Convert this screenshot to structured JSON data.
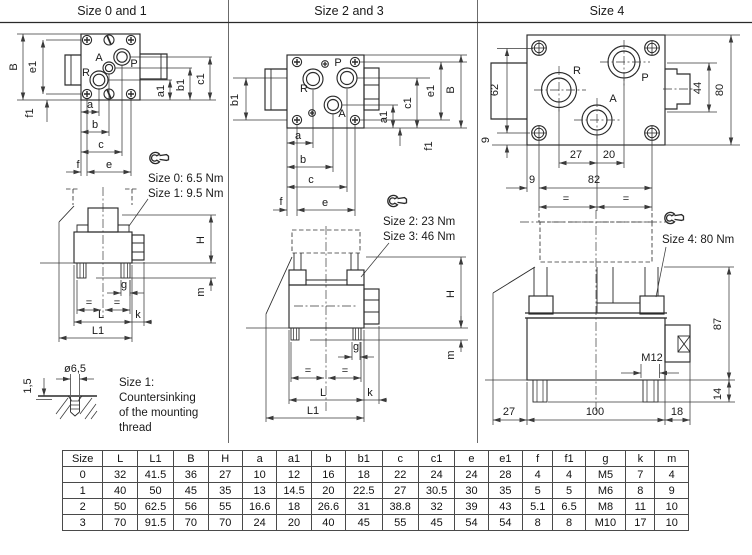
{
  "panels": {
    "p1": {
      "title": "Size 0 and 1"
    },
    "p2": {
      "title": "Size 2 and 3"
    },
    "p3": {
      "title": "Size 4"
    }
  },
  "d1": {
    "ports": {
      "r": "R",
      "a": "A",
      "p": "P"
    },
    "dims": {
      "B": "B",
      "e1": "e1",
      "f1": "f1",
      "a": "a",
      "b": "b",
      "c": "c",
      "e": "e",
      "f": "f",
      "a1": "a1",
      "b1": "b1",
      "c1": "c1",
      "H": "H",
      "m": "m",
      "g": "g",
      "k": "k",
      "L": "L",
      "L1": "L1",
      "eq": "="
    },
    "torque": {
      "line1": "Size 0: 6.5 Nm",
      "line2": "Size 1: 9.5 Nm"
    },
    "countersink": {
      "depth": "1,5",
      "diameter": "ø6,5",
      "note_line1": "Size 1:",
      "note_line2": "Countersinking",
      "note_line3": "of the mounting",
      "note_line4": "thread"
    }
  },
  "d2": {
    "ports": {
      "r": "R",
      "a": "A",
      "p": "P"
    },
    "dims": {
      "B": "B",
      "e1": "e1",
      "f1": "f1",
      "a": "a",
      "b": "b",
      "c": "c",
      "e": "e",
      "f": "f",
      "a1": "a1",
      "b1": "b1",
      "c1": "c1",
      "H": "H",
      "m": "m",
      "g": "g",
      "k": "k",
      "L": "L",
      "L1": "L1",
      "eq": "="
    },
    "torque": {
      "line1": "Size 2: 23 Nm",
      "line2": "Size 3: 46 Nm"
    }
  },
  "d3": {
    "ports": {
      "r": "R",
      "a": "A",
      "p": "P"
    },
    "dims": {
      "v62": "62",
      "v9_left": "9",
      "v44": "44",
      "v80": "80",
      "v27": "27",
      "v20": "20",
      "v9_bottom": "9",
      "v82": "82",
      "eq": "=",
      "v87": "87",
      "v14": "14",
      "m12": "M12",
      "v27_side": "27",
      "v100": "100",
      "v18": "18"
    },
    "torque": {
      "line1": "Size 4: 80 Nm"
    }
  },
  "table": {
    "headers": [
      "Size",
      "L",
      "L1",
      "B",
      "H",
      "a",
      "a1",
      "b",
      "b1",
      "c",
      "c1",
      "e",
      "e1",
      "f",
      "f1",
      "g",
      "k",
      "m"
    ],
    "rows": [
      [
        "0",
        "32",
        "41.5",
        "36",
        "27",
        "10",
        "12",
        "16",
        "18",
        "22",
        "24",
        "24",
        "28",
        "4",
        "4",
        "M5",
        "7",
        "4"
      ],
      [
        "1",
        "40",
        "50",
        "45",
        "35",
        "13",
        "14.5",
        "20",
        "22.5",
        "27",
        "30.5",
        "30",
        "35",
        "5",
        "5",
        "M6",
        "8",
        "9"
      ],
      [
        "2",
        "50",
        "62.5",
        "56",
        "55",
        "16.6",
        "18",
        "26.6",
        "31",
        "38.8",
        "32",
        "39",
        "43",
        "5.1",
        "6.5",
        "M8",
        "11",
        "10"
      ],
      [
        "3",
        "70",
        "91.5",
        "70",
        "70",
        "24",
        "20",
        "40",
        "45",
        "55",
        "45",
        "54",
        "54",
        "8",
        "8",
        "M10",
        "17",
        "10"
      ]
    ]
  }
}
